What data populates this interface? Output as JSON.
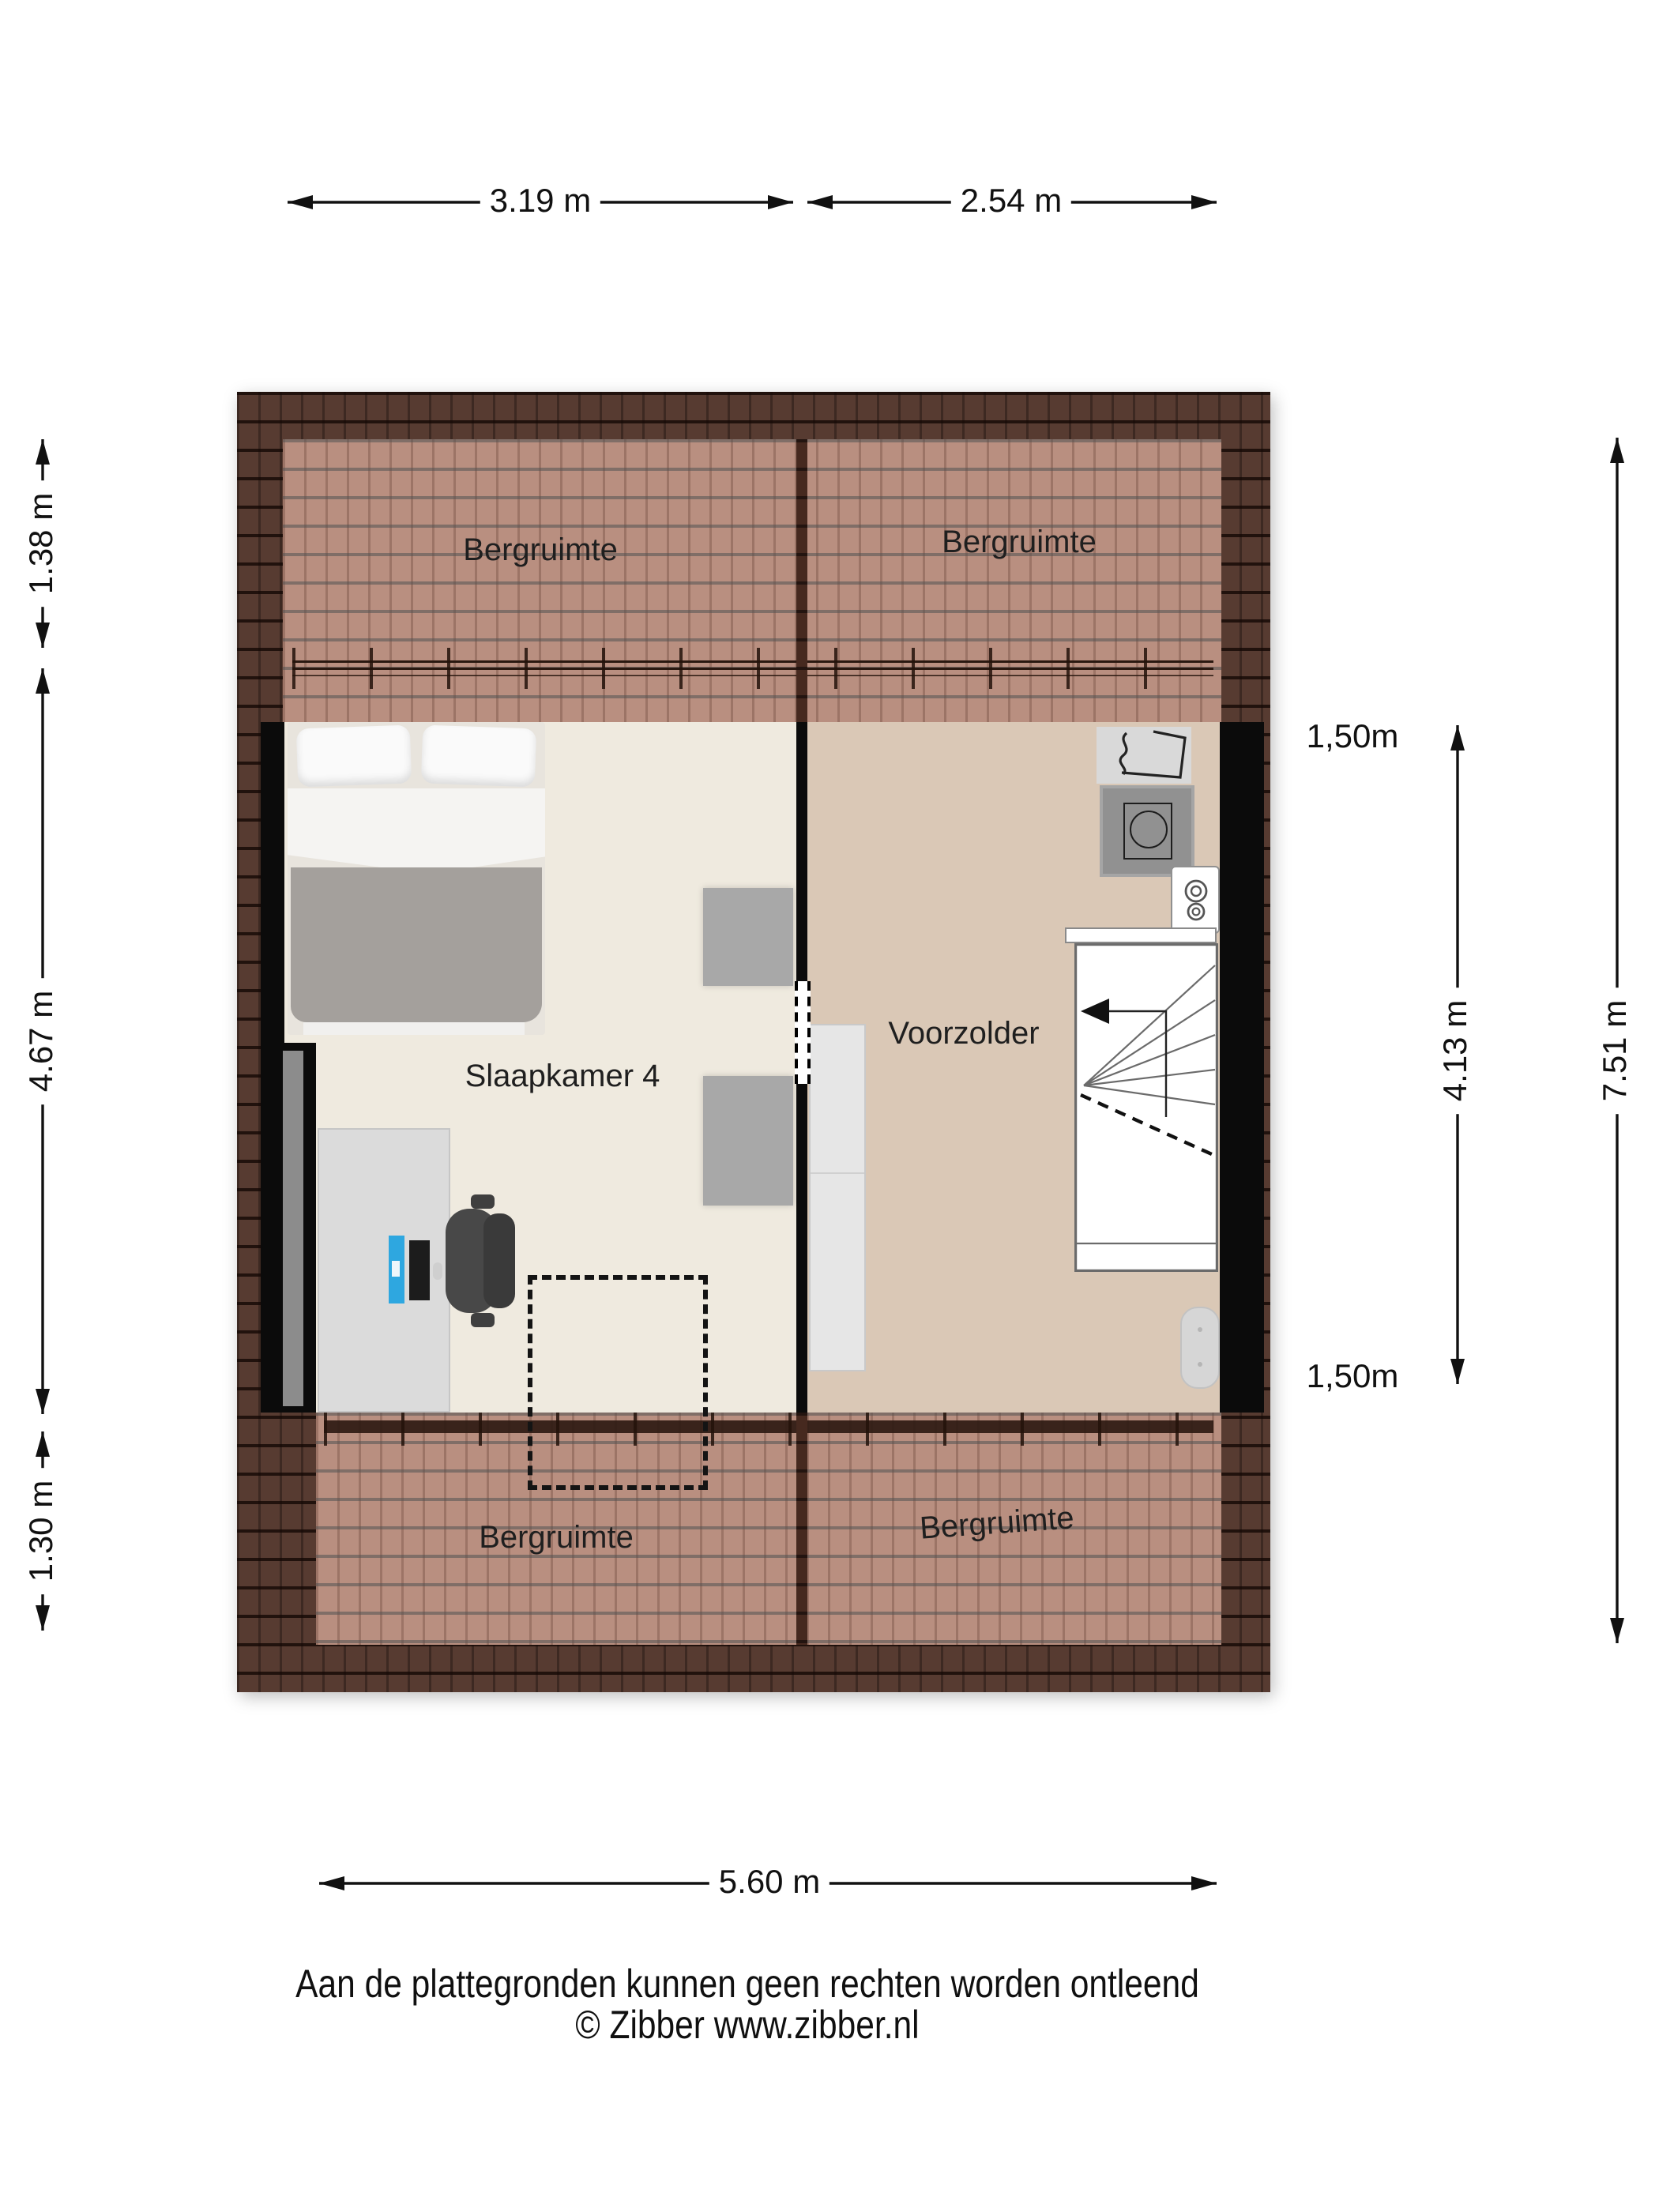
{
  "rooms": {
    "bergruimte_top_left": "Bergruimte",
    "bergruimte_top_right": "Bergruimte",
    "slaapkamer4": "Slaapkamer 4",
    "voorzolder": "Voorzolder",
    "bergruimte_bottom_left": "Bergruimte",
    "bergruimte_bottom_right": "Bergruimte"
  },
  "dimensions": {
    "top": [
      {
        "label": "3.19 m"
      },
      {
        "label": "2.54 m"
      }
    ],
    "left": [
      {
        "label": "1.38 m"
      },
      {
        "label": "4.67 m"
      },
      {
        "label": "1.30 m"
      }
    ],
    "right": [
      {
        "label": "1,50m"
      },
      {
        "label": "4.13 m"
      },
      {
        "label": "7.51 m"
      },
      {
        "label": "1,50m"
      }
    ],
    "bottom": [
      {
        "label": "5.60 m"
      }
    ]
  },
  "footer": {
    "disclaimer": "Aan de plattegronden kunnen geen rechten worden ontleend",
    "copyright": "© Zibber www.zibber.nl"
  },
  "colors": {
    "roof_dark": "#573b31",
    "roof_light": "#b98f80",
    "floor_slaapkamer": "#efeadf",
    "floor_voorzolder": "#dac8b6",
    "wall": "#0b0b0b",
    "laptop_screen": "#2ea7e0"
  }
}
